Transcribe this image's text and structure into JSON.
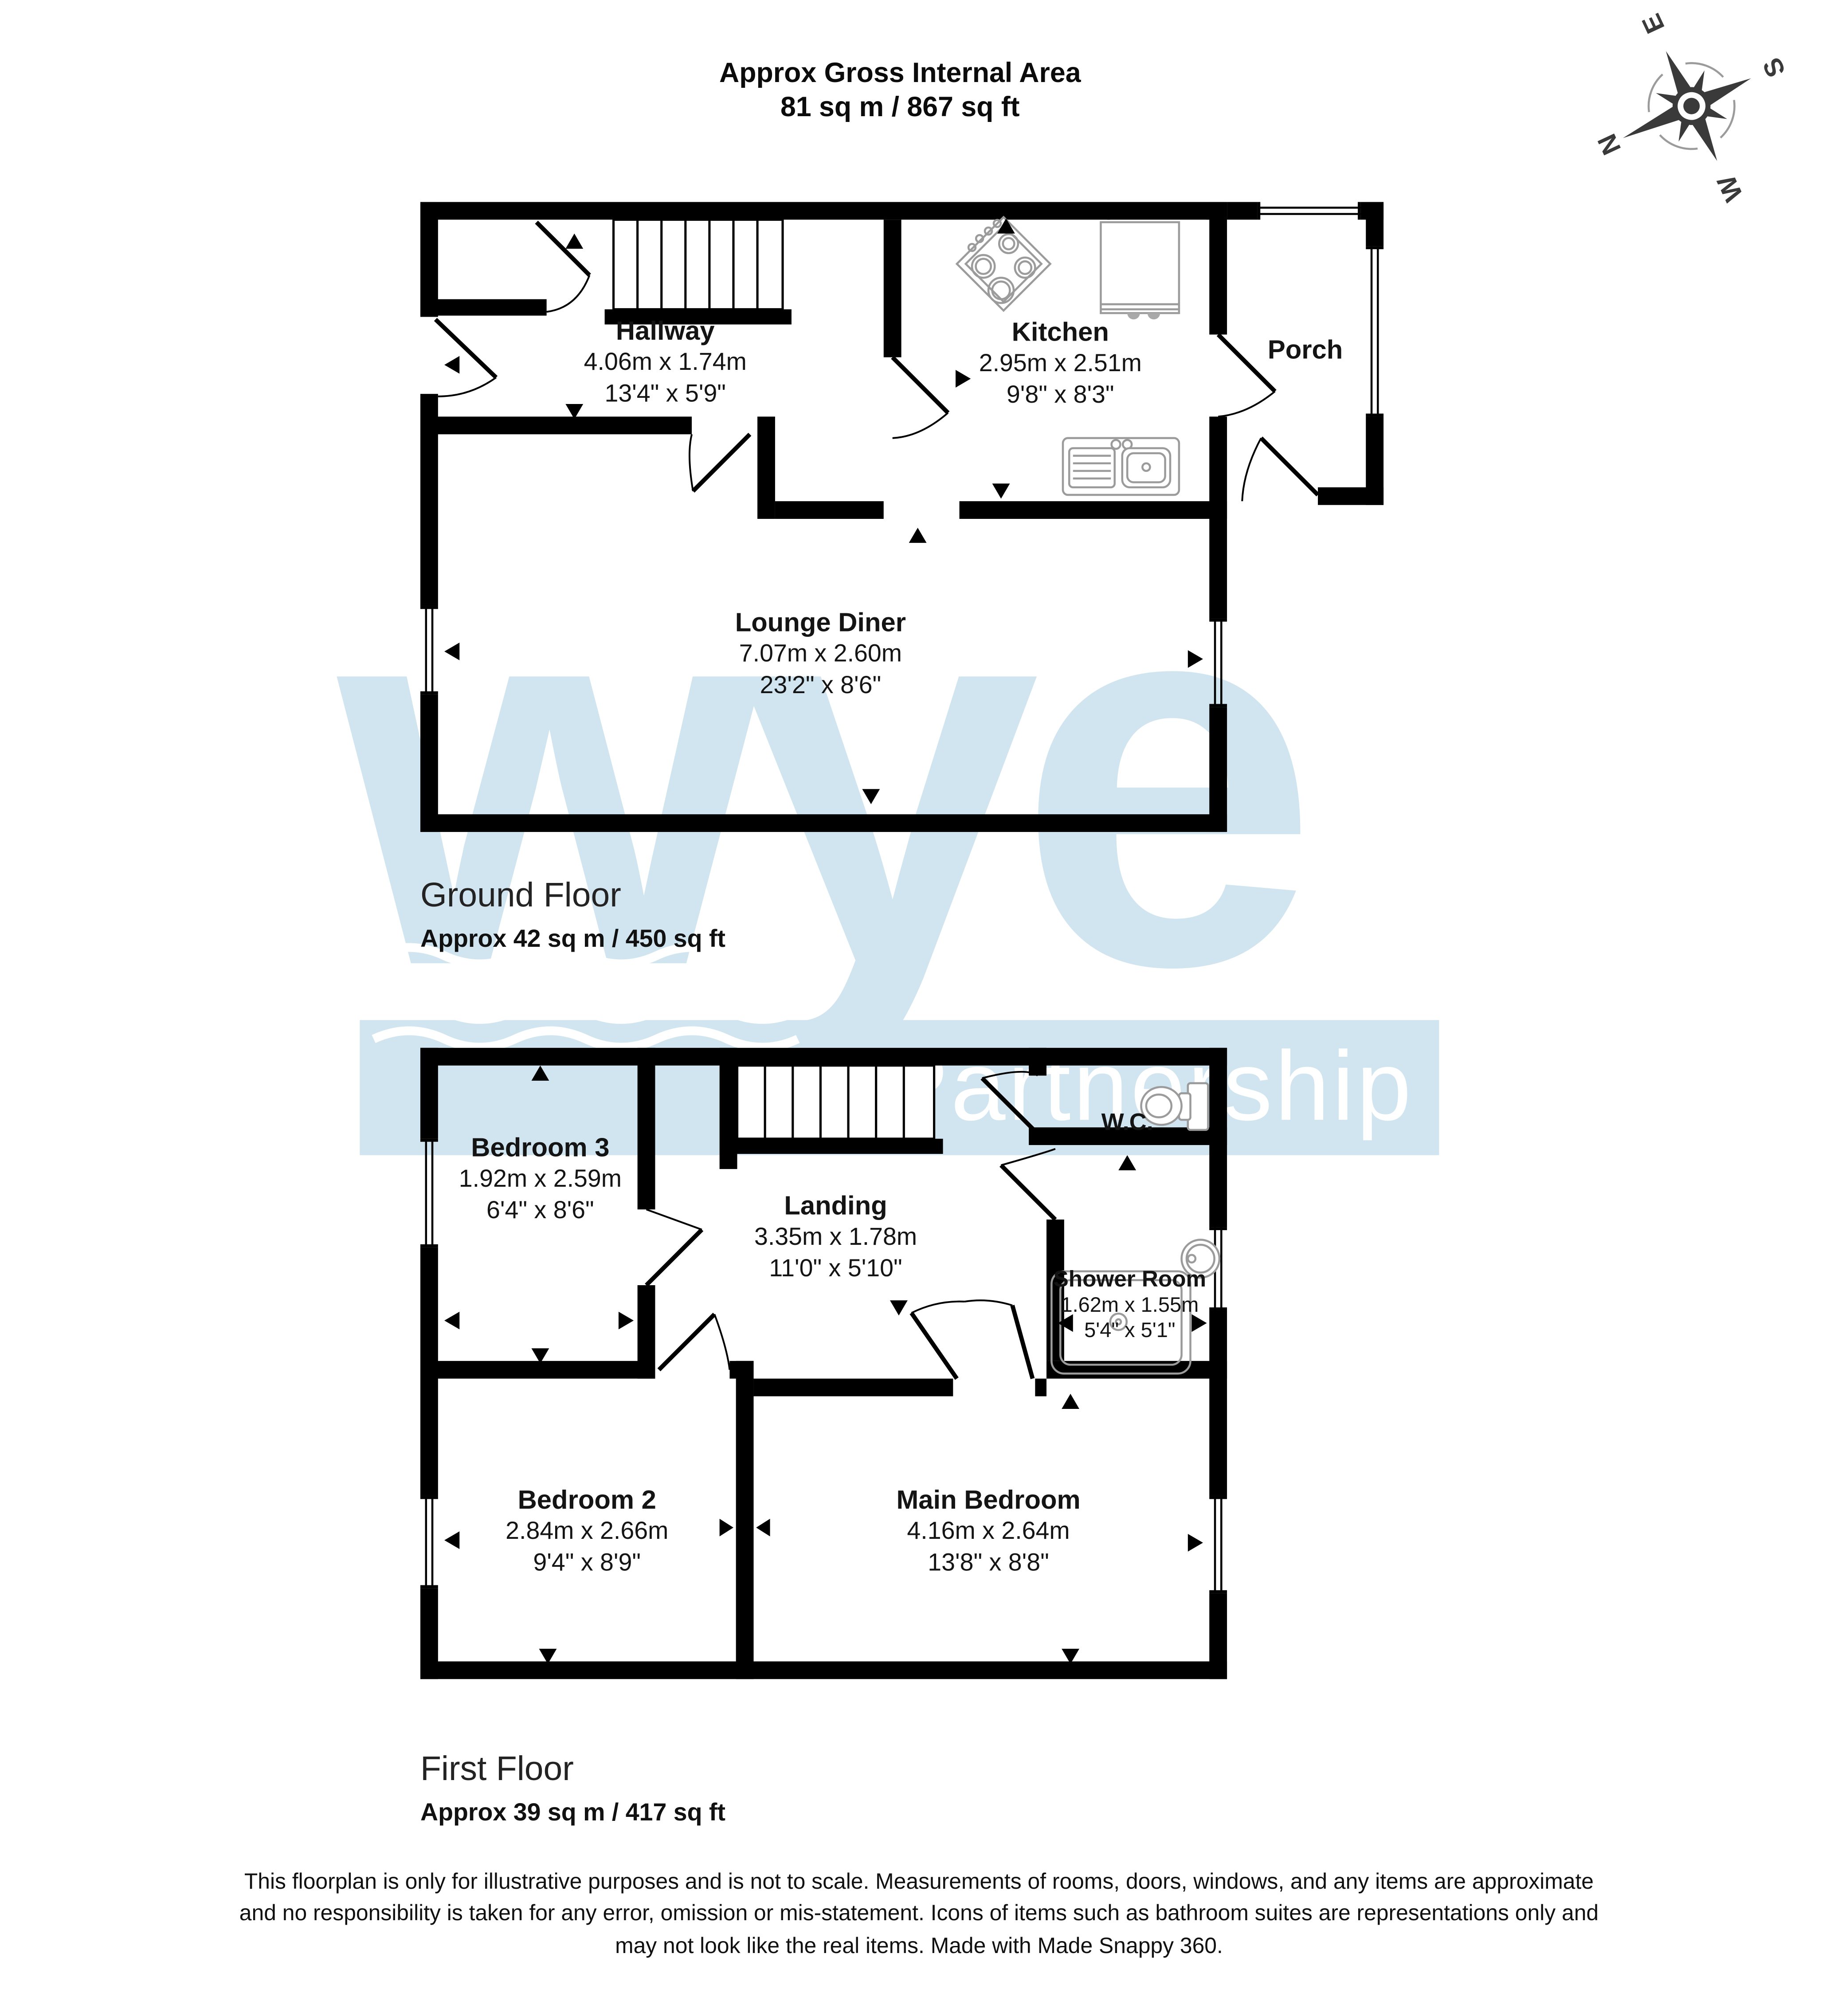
{
  "title": {
    "line1": "Approx Gross Internal Area",
    "line2": "81 sq m / 867 sq ft"
  },
  "compass": {
    "n": "N",
    "e": "E",
    "s": "S",
    "w": "W",
    "rotation_deg": -115
  },
  "watermark": {
    "word": "wye",
    "sub": "Partnership",
    "color": "#d0e5ef"
  },
  "floors": [
    {
      "name": "Ground Floor",
      "area": "Approx 42 sq m / 450 sq ft",
      "rooms": [
        {
          "name": "Hallway",
          "metric": "4.06m x 1.74m",
          "imperial": "13'4\" x 5'9\""
        },
        {
          "name": "Kitchen",
          "metric": "2.95m x 2.51m",
          "imperial": "9'8\" x 8'3\""
        },
        {
          "name": "Porch",
          "metric": "",
          "imperial": ""
        },
        {
          "name": "Lounge Diner",
          "metric": "7.07m x 2.60m",
          "imperial": "23'2\" x 8'6\""
        }
      ]
    },
    {
      "name": "First Floor",
      "area": "Approx 39 sq m / 417 sq ft",
      "rooms": [
        {
          "name": "Bedroom 3",
          "metric": "1.92m x 2.59m",
          "imperial": "6'4\" x 8'6\""
        },
        {
          "name": "Landing",
          "metric": "3.35m x 1.78m",
          "imperial": "11'0\" x 5'10\""
        },
        {
          "name": "W.C.",
          "metric": "",
          "imperial": ""
        },
        {
          "name": "Shower Room",
          "metric": "1.62m x 1.55m",
          "imperial": "5'4\" x 5'1\""
        },
        {
          "name": "Bedroom 2",
          "metric": "2.84m x 2.66m",
          "imperial": "9'4\" x 8'9\""
        },
        {
          "name": "Main Bedroom",
          "metric": "4.16m x 2.64m",
          "imperial": "13'8\" x 8'8\""
        }
      ]
    }
  ],
  "fixtures": [
    "compass-rose-icon",
    "staircase-icon",
    "hob-icon",
    "kitchen-sink-icon",
    "counter-unit-icon",
    "toilet-icon",
    "shower-tray-icon",
    "wash-basin-icon"
  ],
  "footer": {
    "line1": "This floorplan is only for illustrative purposes and is not to scale. Measurements of rooms, doors, windows, and any items are approximate",
    "line2": "and no responsibility is taken for any error, omission or mis-statement. Icons of items such as bathroom suites are representations only and",
    "line3": "may not look like the real items. Made with Made Snappy 360."
  }
}
